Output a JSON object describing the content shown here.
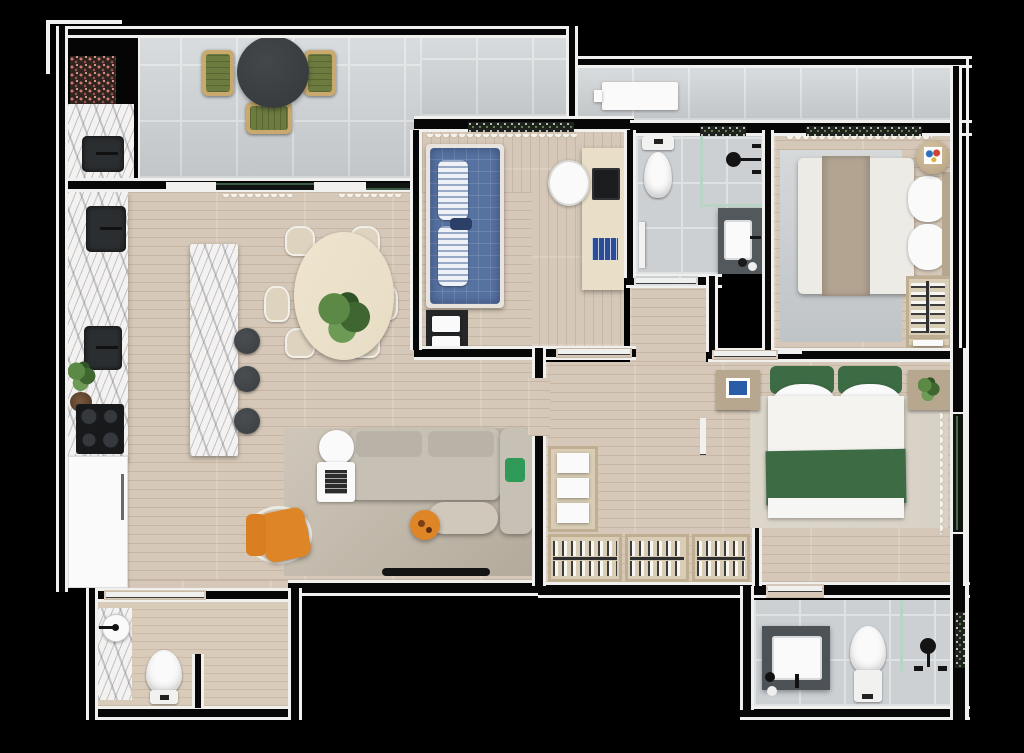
{
  "title": "apartment-floor-plan-top-view",
  "palette": {
    "bg": "#000000",
    "wall": "#f0f0ee",
    "tile": "#ccd0d3",
    "tileLine": "#dfe2e4",
    "wood": "#d6c8b8",
    "tan": "#d9cbb9",
    "marble": "#f3f2f1",
    "fixture": "#2b2e30",
    "white": "#fafafa",
    "greenChair": "#6c7b3e",
    "trim": "#c9a96d",
    "tableDark": "#35383b",
    "plant": "#4d7a3b",
    "dining": "#e7dcc4",
    "chair": "#ddd3bf",
    "stool": "#3b3e41",
    "sofa": "#c6c0b5",
    "rug": "#c3bbac",
    "orange": "#dd8527",
    "blueBed": "#5672a1",
    "desk": "#e9dfc9",
    "books": "#2d4c96",
    "vanity": "#53585c",
    "glass": "#b8d4c4",
    "duvet": "#edebe6",
    "taupe": "#b3a492",
    "closetWood": "#c0ae92",
    "masterGreen": "#3d6b44",
    "rugGray": "#ccd0d4",
    "rugMaster": "#d8d2c6",
    "flowerRed": "#cf7a6e",
    "nightstand": "#b7a78f"
  },
  "rooms": [
    {
      "id": "terrace",
      "label": "terrace-gourmet-balcony",
      "items": [
        "round-outdoor-table",
        "outdoor-chair-x3",
        "flower-planter",
        "grill-counter",
        "grill-sink",
        "condenser-unit"
      ]
    },
    {
      "id": "kitchen",
      "label": "kitchen",
      "items": [
        "marble-counter",
        "sink-x2",
        "cooktop",
        "herb-plant",
        "refrigerator",
        "island",
        "bar-stool-x3"
      ]
    },
    {
      "id": "living-dining",
      "label": "living-dining",
      "items": [
        "oval-dining-table",
        "dining-chair-x6",
        "centerpiece-plant",
        "sofa",
        "chaise",
        "green-pillow",
        "coffee-table",
        "side-table",
        "book-stack",
        "ottoman",
        "orange-armchair",
        "orange-side-table",
        "area-rug",
        "tv"
      ]
    },
    {
      "id": "bedroom-single",
      "label": "single-bedroom",
      "items": [
        "single-bed-blue",
        "striped-pillow-x2",
        "under-bed-shelf",
        "towel-stack-x2",
        "desk",
        "desk-chair",
        "laptop",
        "blue-books",
        "window-planter",
        "curtain"
      ]
    },
    {
      "id": "bathroom",
      "label": "bathroom",
      "items": [
        "toilet",
        "glass-shower",
        "shower-head",
        "body-spout-x2",
        "vanity",
        "sink",
        "towel-rolls",
        "hanging-towel"
      ]
    },
    {
      "id": "bedroom-double",
      "label": "double-bedroom",
      "items": [
        "double-bed",
        "taupe-runner",
        "pillow-x2",
        "round-side-table",
        "wall-art",
        "rug",
        "hanger-closet",
        "folded-linen-shelf",
        "window-planter",
        "curtain"
      ]
    },
    {
      "id": "master-bedroom",
      "label": "master-bedroom",
      "items": [
        "double-bed-green",
        "green-headboard-cushion-x2",
        "pillow-x2",
        "green-throw",
        "nightstand-x2",
        "framed-photo",
        "potted-plant",
        "rug",
        "window",
        "curtain"
      ]
    },
    {
      "id": "walk-in-closet",
      "label": "walk-in-closet",
      "items": [
        "shelf-unit",
        "folded-stack-x3",
        "hanger-rack-x3"
      ]
    },
    {
      "id": "powder-room",
      "label": "powder-room",
      "items": [
        "marble-vanity",
        "round-vessel-sink",
        "black-faucet",
        "toilet"
      ]
    },
    {
      "id": "master-bathroom",
      "label": "master-bathroom",
      "items": [
        "dark-vanity",
        "sink",
        "faucet",
        "towel-rolls",
        "toilet",
        "glass-partition",
        "shower-head",
        "spout-x2",
        "window-greenery"
      ]
    },
    {
      "id": "hallway",
      "label": "hallway",
      "items": [
        "door-x5"
      ]
    }
  ]
}
